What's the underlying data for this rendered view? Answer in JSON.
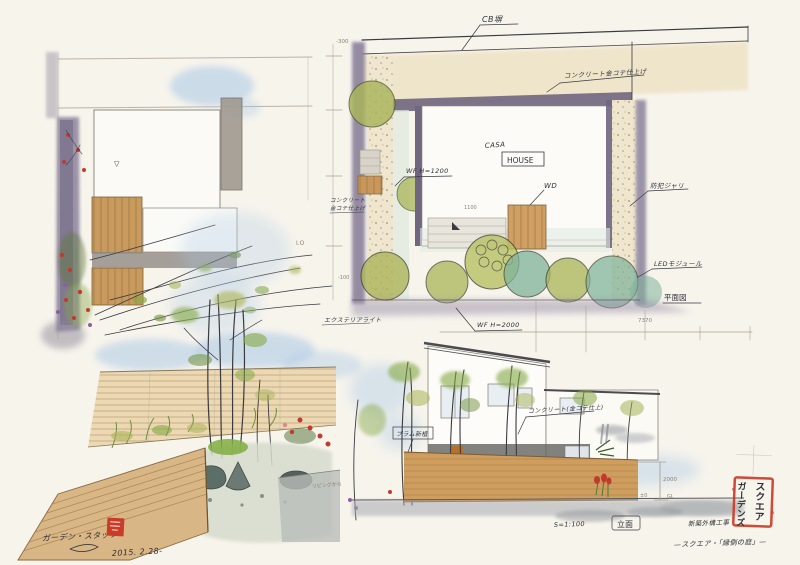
{
  "plan": {
    "cb_wall": "CB塀",
    "concrete_finish": "コンクリート金コテ仕上げ",
    "casa": "CASA",
    "house": "HOUSE",
    "wood_deck": "WD",
    "fence_h1200": "WF H=1200",
    "note_concrete_1": "コンクリート",
    "note_concrete_2": "金コテ仕上げ",
    "gravel": "防犯ジャリ",
    "led": "LEDモジュール",
    "exterior_light": "エクステリアライト",
    "fence_h2000": "WF H=2000",
    "dim_7370": "7370",
    "dim_300": "-300",
    "dim_100": "-100",
    "dim_1100": "1100",
    "title": "平面図"
  },
  "sketch_top_left": {
    "level_mark": "▽",
    "pencil_note": "I.O"
  },
  "perspective": {
    "room_note": "リビングから"
  },
  "elevation": {
    "plum_note": "プラム新植",
    "concrete_note": "コンクリート(金コテ仕上)",
    "dim_2000": "2000",
    "datum_zero": "±0",
    "gl": "GL",
    "scale": "S=1:100",
    "title": "立面"
  },
  "footer": {
    "signature": "ガーデン・スタッフ",
    "date": "2015. 2.28-",
    "project_line1": "新築外構工事",
    "project_line2": "—スクエア・「縁側の庭」—"
  },
  "stamps": {
    "large_seal_col_right": "スクエア",
    "large_seal_col_left": "ガーデンズ"
  },
  "colors": {
    "paper": "#f7f4ec",
    "ink": "#3a3a40",
    "pencil": "#aba293",
    "wall_purple": "#8b819b",
    "concrete_beige": "#eee3c6",
    "wood": "#c9975c",
    "olive_green": "#aab457",
    "teal_green": "#7fb39b",
    "leaf_green": "#85a845",
    "sky_blue": "#a9c8e6",
    "flower_red": "#c23a2e",
    "seal_red": "#cc3b27",
    "shadow_gray": "#9aa0a4"
  }
}
